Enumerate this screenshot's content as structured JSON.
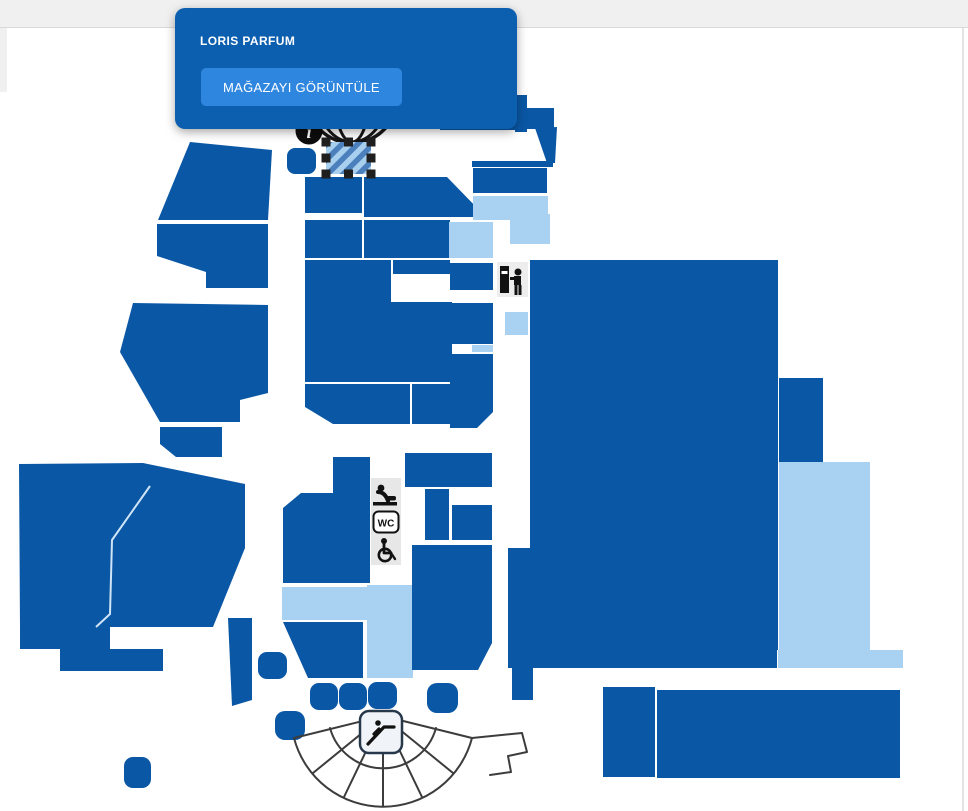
{
  "tooltip": {
    "store_name": "LORIS PARFUM",
    "button_label": "MAĞAZAYI GÖRÜNTÜLE"
  },
  "icons": {
    "info_glyph": "i",
    "wc_label": "WC",
    "names": [
      "info-icon",
      "globe-icon",
      "atm-icon",
      "baby-changing-icon",
      "wc-icon",
      "wheelchair-icon",
      "escalator-icon",
      "amphitheater-outline"
    ]
  },
  "colors": {
    "store": "#0a57a5",
    "store_light": "#a9d2f2",
    "selected_stripe_a": "#4c80bd",
    "selected_stripe_b": "#a8d0ee",
    "handle": "#1f1f1f",
    "tooltip_bg": "#0c5fae",
    "button_bg": "#2e86df",
    "topbar_bg": "#f0f0f0",
    "fan_stroke": "#3c3c3c",
    "facility_strip_bg": "#e7e7e7"
  },
  "map": {
    "shapes": [
      {
        "name": "store-nw-a",
        "type": "polygon",
        "fill": "dark",
        "points": "190,142 272,150 268,220 158,220"
      },
      {
        "name": "store-nw-b",
        "type": "polygon",
        "fill": "dark",
        "points": "157,224 268,224 268,288 206,288 206,272 157,256"
      },
      {
        "name": "store-w-c",
        "type": "polygon",
        "fill": "dark",
        "points": "133,303 268,305 268,393 240,400 240,422 160,422 120,352"
      },
      {
        "name": "store-w-d",
        "type": "polygon",
        "fill": "dark",
        "points": "160,427 222,427 222,457 176,457 160,444"
      },
      {
        "name": "store-sw-anchor",
        "type": "polygon",
        "fill": "dark",
        "points": "19,464 143,463 245,484 245,548 213,627 20,627"
      },
      {
        "name": "store-sw-step-a",
        "type": "rect",
        "fill": "dark",
        "x": 20,
        "y": 627,
        "w": 90,
        "h": 22
      },
      {
        "name": "store-sw-step-b",
        "type": "rect",
        "fill": "dark",
        "x": 60,
        "y": 649,
        "w": 103,
        "h": 22
      },
      {
        "name": "store-sw-tail",
        "type": "polygon",
        "fill": "dark",
        "points": "228,618 252,618 252,700 232,706"
      },
      {
        "name": "store-col-left",
        "type": "polygon",
        "fill": "dark",
        "points": "333,457 370,457 370,583 283,583 283,508 301,493 333,493"
      },
      {
        "name": "store-mid-light",
        "type": "rect",
        "fill": "light",
        "x": 282,
        "y": 587,
        "w": 85,
        "h": 33
      },
      {
        "name": "store-below-light",
        "type": "polygon",
        "fill": "dark",
        "points": "283,622 363,622 363,678 308,678"
      },
      {
        "name": "corridor-light",
        "type": "rect",
        "fill": "light",
        "x": 367,
        "y": 585,
        "w": 46,
        "h": 93
      },
      {
        "name": "store-right-big",
        "type": "polygon",
        "fill": "dark",
        "points": "412,545 492,545 492,643 478,670 412,670"
      },
      {
        "name": "store-row1-l",
        "type": "rect",
        "fill": "dark",
        "x": 305,
        "y": 177,
        "w": 57,
        "h": 36
      },
      {
        "name": "store-row1-r",
        "type": "polygon",
        "fill": "dark",
        "points": "364,177 447,177 481,212 481,217 364,217"
      },
      {
        "name": "store-m-a",
        "type": "rect",
        "fill": "dark",
        "x": 305,
        "y": 220,
        "w": 57,
        "h": 38
      },
      {
        "name": "store-m-b",
        "type": "rect",
        "fill": "dark",
        "x": 364,
        "y": 220,
        "w": 86,
        "h": 38
      },
      {
        "name": "store-m2-light",
        "type": "rect",
        "fill": "light",
        "x": 449,
        "y": 222,
        "w": 44,
        "h": 36
      },
      {
        "name": "store-m3",
        "type": "rect",
        "fill": "dark",
        "x": 450,
        "y": 263,
        "w": 43,
        "h": 27
      },
      {
        "name": "store-m4",
        "type": "polygon",
        "fill": "dark",
        "points": "305,260 391,260 391,302 452,302 452,382 305,382"
      },
      {
        "name": "store-m4b",
        "type": "rect",
        "fill": "dark",
        "x": 393,
        "y": 260,
        "w": 57,
        "h": 14
      },
      {
        "name": "store-m5",
        "type": "rect",
        "fill": "dark",
        "x": 450,
        "y": 303,
        "w": 43,
        "h": 41
      },
      {
        "name": "store-m-sliver",
        "type": "rect",
        "fill": "light",
        "x": 472,
        "y": 345,
        "w": 21,
        "h": 7
      },
      {
        "name": "store-m7",
        "type": "polygon",
        "fill": "dark",
        "points": "450,354 493,354 493,412 477,428 450,428"
      },
      {
        "name": "store-m8",
        "type": "polygon",
        "fill": "dark",
        "points": "305,384 410,384 410,424 333,424 305,407"
      },
      {
        "name": "store-m9",
        "type": "rect",
        "fill": "dark",
        "x": 412,
        "y": 384,
        "w": 38,
        "h": 40
      },
      {
        "name": "store-cr-a",
        "type": "rect",
        "fill": "dark",
        "x": 405,
        "y": 453,
        "w": 87,
        "h": 34
      },
      {
        "name": "store-cr-b",
        "type": "rect",
        "fill": "dark",
        "x": 425,
        "y": 489,
        "w": 24,
        "h": 51
      },
      {
        "name": "store-cr-c",
        "type": "rect",
        "fill": "dark",
        "x": 452,
        "y": 505,
        "w": 40,
        "h": 35
      },
      {
        "name": "store-tr-a",
        "type": "rect",
        "fill": "dark",
        "x": 440,
        "y": 80,
        "w": 77,
        "h": 50
      },
      {
        "name": "store-tr-step",
        "type": "rect",
        "fill": "dark",
        "x": 515,
        "y": 95,
        "w": 12,
        "h": 37
      },
      {
        "name": "store-tr-b",
        "type": "rect",
        "fill": "dark",
        "x": 526,
        "y": 108,
        "w": 28,
        "h": 21
      },
      {
        "name": "store-tr-c",
        "type": "polygon",
        "fill": "dark",
        "points": "535,128 557,127 555,163 547,163"
      },
      {
        "name": "store-tr-strip",
        "type": "rect",
        "fill": "dark",
        "x": 472,
        "y": 161,
        "w": 81,
        "h": 6
      },
      {
        "name": "store-tr-d",
        "type": "rect",
        "fill": "dark",
        "x": 473,
        "y": 168,
        "w": 74,
        "h": 25
      },
      {
        "name": "store-tr-light-a",
        "type": "rect",
        "fill": "light",
        "x": 473,
        "y": 196,
        "w": 75,
        "h": 24
      },
      {
        "name": "store-tr-light-b",
        "type": "rect",
        "fill": "light",
        "x": 510,
        "y": 214,
        "w": 40,
        "h": 30
      },
      {
        "name": "store-anchor",
        "type": "polygon",
        "fill": "dark",
        "points": "530,260 778,260 778,650 777,650 777,668 508,668 508,548 530,548"
      },
      {
        "name": "store-anchor-ext",
        "type": "rect",
        "fill": "dark",
        "x": 779,
        "y": 378,
        "w": 44,
        "h": 84
      },
      {
        "name": "store-anchor-light",
        "type": "rect",
        "fill": "light",
        "x": 779,
        "y": 462,
        "w": 91,
        "h": 188
      },
      {
        "name": "store-bottom-light-strip",
        "type": "rect",
        "fill": "light",
        "x": 778,
        "y": 650,
        "w": 125,
        "h": 18
      },
      {
        "name": "store-se-small",
        "type": "rect",
        "fill": "dark",
        "x": 512,
        "y": 668,
        "w": 21,
        "h": 32
      },
      {
        "name": "store-se-a",
        "type": "rect",
        "fill": "dark",
        "x": 603,
        "y": 687,
        "w": 52,
        "h": 90
      },
      {
        "name": "store-se-b",
        "type": "rect",
        "fill": "dark",
        "x": 657,
        "y": 690,
        "w": 243,
        "h": 88
      },
      {
        "name": "store-light-sq",
        "type": "rect",
        "fill": "light",
        "x": 505,
        "y": 312,
        "w": 23,
        "h": 23
      },
      {
        "name": "kiosk-1",
        "type": "rect",
        "fill": "dark",
        "x": 258,
        "y": 652,
        "w": 29,
        "h": 27,
        "rx": 9
      },
      {
        "name": "kiosk-2",
        "type": "rect",
        "fill": "dark",
        "x": 310,
        "y": 683,
        "w": 28,
        "h": 27,
        "rx": 9
      },
      {
        "name": "kiosk-3",
        "type": "rect",
        "fill": "dark",
        "x": 339,
        "y": 683,
        "w": 28,
        "h": 27,
        "rx": 9
      },
      {
        "name": "kiosk-4",
        "type": "rect",
        "fill": "dark",
        "x": 368,
        "y": 682,
        "w": 29,
        "h": 27,
        "rx": 9
      },
      {
        "name": "kiosk-5",
        "type": "rect",
        "fill": "dark",
        "x": 427,
        "y": 683,
        "w": 31,
        "h": 30,
        "rx": 10
      },
      {
        "name": "kiosk-6",
        "type": "rect",
        "fill": "dark",
        "x": 275,
        "y": 711,
        "w": 30,
        "h": 29,
        "rx": 10
      },
      {
        "name": "kiosk-7",
        "type": "rect",
        "fill": "dark",
        "x": 124,
        "y": 757,
        "w": 27,
        "h": 31,
        "rx": 9
      },
      {
        "name": "info-kiosk",
        "type": "rect",
        "fill": "dark",
        "x": 287,
        "y": 148,
        "w": 29,
        "h": 26,
        "rx": 8
      },
      {
        "name": "selected-store",
        "type": "rect",
        "fill": "selected",
        "x": 326,
        "y": 142,
        "w": 45,
        "h": 32
      }
    ]
  }
}
